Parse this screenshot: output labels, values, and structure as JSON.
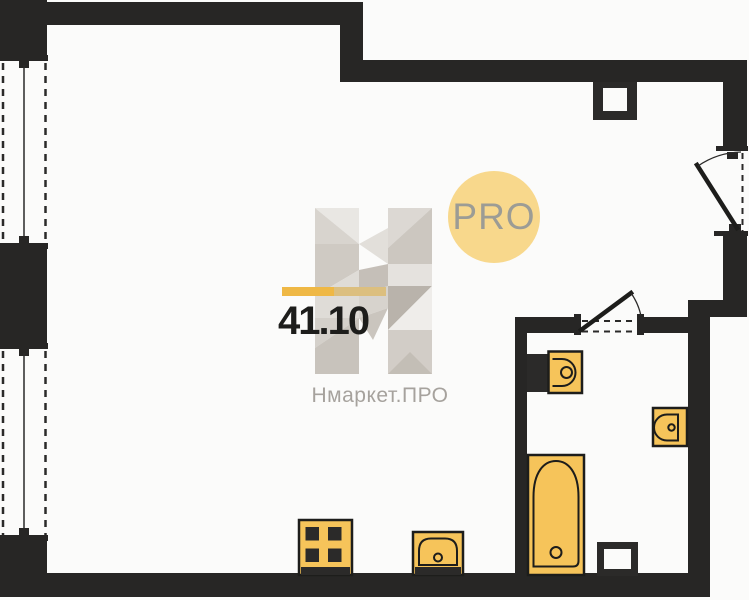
{
  "plan": {
    "area_label": "41.10",
    "badge_label": "PRO",
    "brand_watermark": "Нмаркет.ПРО"
  },
  "icons": {
    "fixtures": [
      "stove-icon",
      "kitchen-sink-icon",
      "toilet-icon",
      "washbasin-icon",
      "bathtub-icon",
      "ventilation-duct-icon",
      "door-swing-icon",
      "window-icon"
    ]
  },
  "colors": {
    "background": "#fbfbfa",
    "wall": "#272625",
    "line": "#2b2a29",
    "fixture_fill": "#f6c45a",
    "fixture_stroke": "#1d1d1b",
    "accent_bar": "#efb845",
    "accent_bar_muted": "#dcbf7f",
    "badge_bg": "#f8d88c",
    "badge_text": "#9c9c95",
    "area_text": "#1d1d1b",
    "watermark_text": "#a6a29d"
  }
}
